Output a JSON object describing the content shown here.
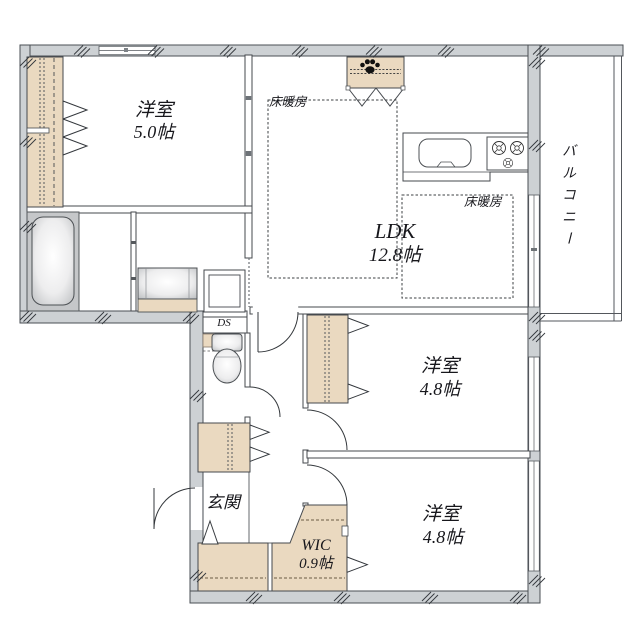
{
  "plan_type": "floorplan",
  "rooms": {
    "western1": {
      "name": "洋室",
      "size": "5.0帖"
    },
    "ldk": {
      "name": "LDK",
      "size": "12.8帖"
    },
    "western2": {
      "name": "洋室",
      "size": "4.8帖"
    },
    "western3": {
      "name": "洋室",
      "size": "4.8帖"
    },
    "balcony": {
      "name": "バルコニー"
    },
    "entrance": {
      "name": "玄関"
    },
    "wic": {
      "name": "WIC",
      "size": "0.9帖"
    },
    "duct": {
      "name": "DS"
    }
  },
  "notes": {
    "floor_heating": "床暖房"
  },
  "icons": {
    "pet_area": "paw-print-icon"
  },
  "colors": {
    "wall_fill": "#cdd1d4",
    "closet_fill": "#ead9c0",
    "bath_fill": "#c5c7c9",
    "line": "#45494e",
    "floor": "#ffffff"
  }
}
